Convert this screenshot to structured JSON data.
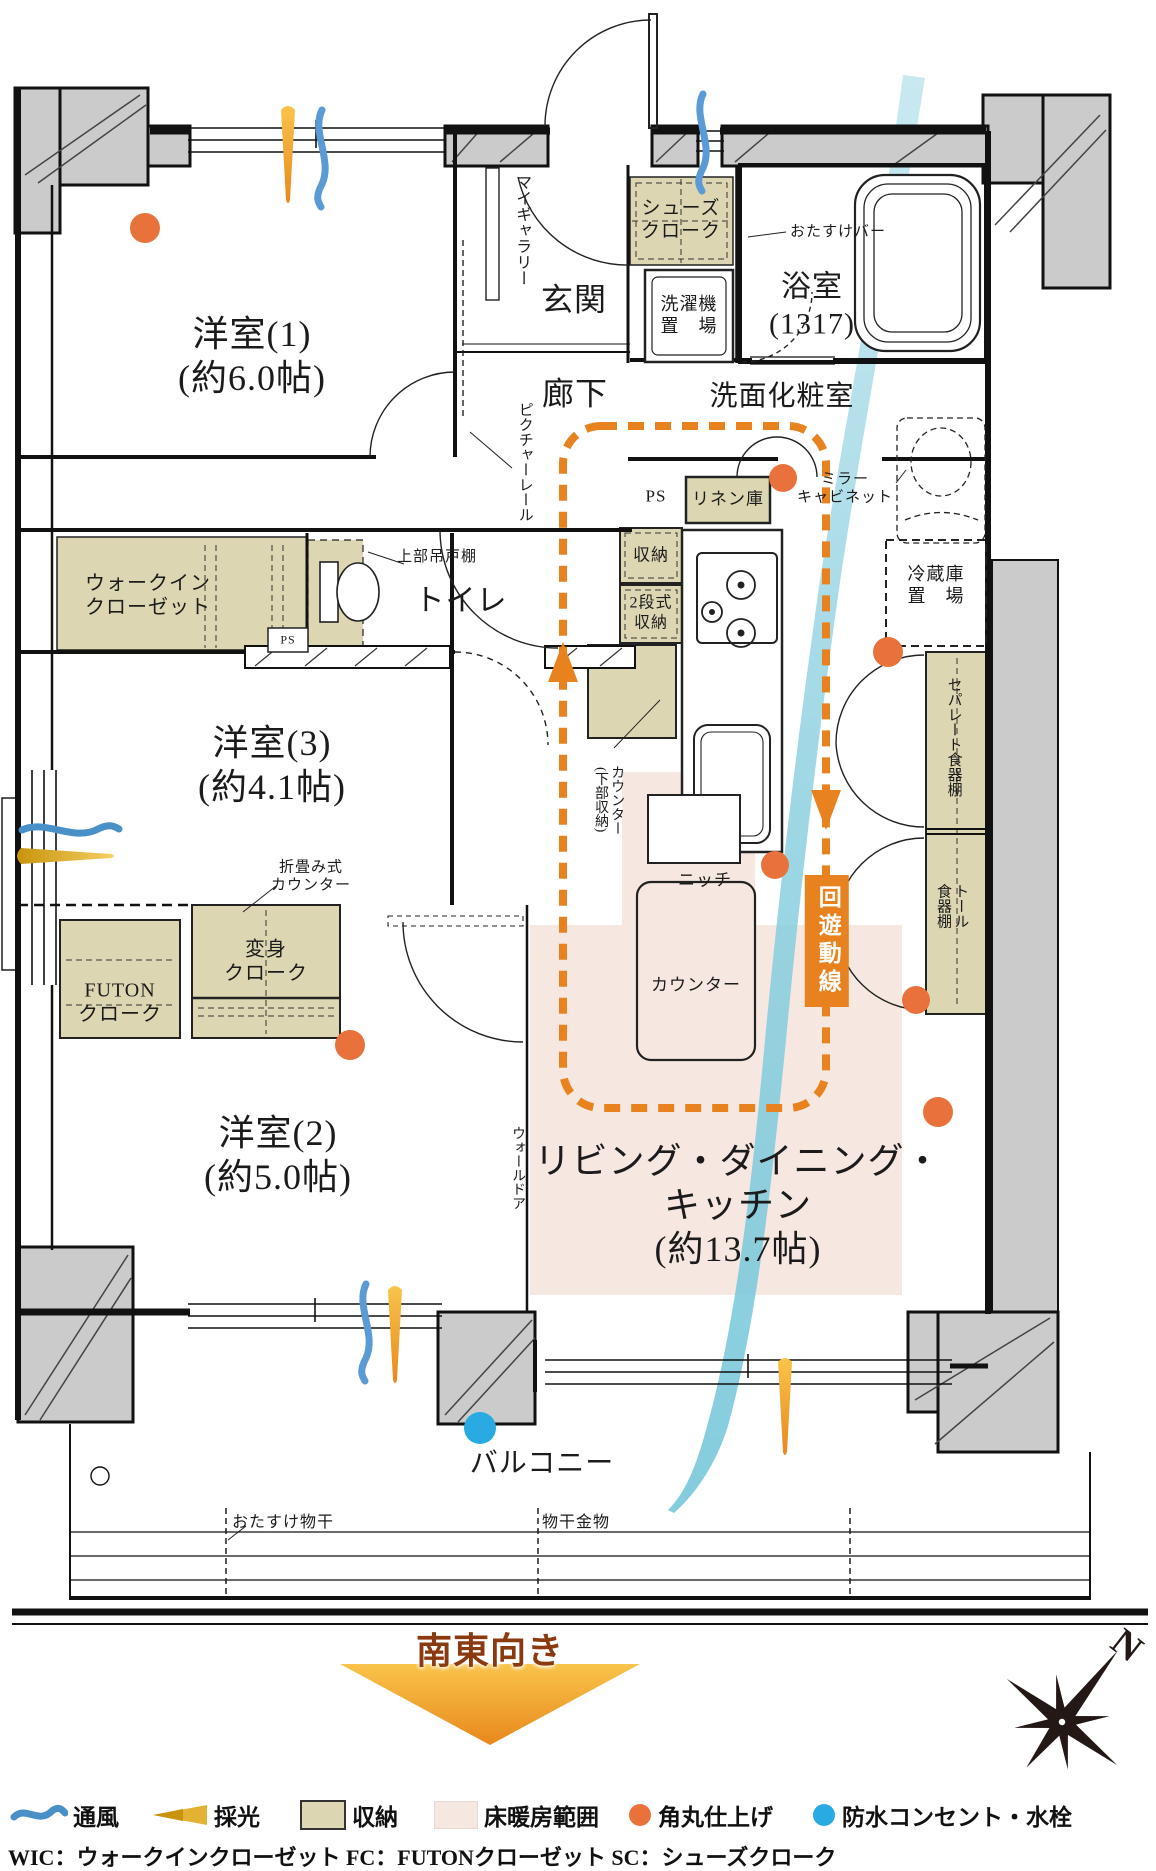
{
  "title": "マンション間取り図（3LDK）",
  "colors": {
    "accent_orange": "#e8821e",
    "corner_dot_orange": "#e8713c",
    "storage_tan": "#dcd7b2",
    "floor_heating_pink": "#f6e8e1",
    "waterproof_blue": "#29abe2",
    "breeze_blue": "#8fc9e0",
    "daylight_gold": "#f0b42e",
    "pillar_gray": "#cbcbcb",
    "direction_brown": "#8b3a10"
  },
  "plan": {
    "labels": [
      {
        "id": "room-yoshitsu1-label",
        "text": "洋室(1)\n(約6.0帖)",
        "x": 252,
        "y": 357,
        "fs": 36
      },
      {
        "id": "room-yoshitsu3-label",
        "text": "洋室(3)\n(約4.1帖)",
        "x": 272,
        "y": 766,
        "fs": 36
      },
      {
        "id": "room-yoshitsu2-label",
        "text": "洋室(2)\n(約5.0帖)",
        "x": 278,
        "y": 1156,
        "fs": 36
      },
      {
        "id": "room-ldk-label",
        "text": "リビング・ダイニング・\nキッチン\n(約13.7帖)",
        "x": 738,
        "y": 1206,
        "fs": 36
      },
      {
        "id": "room-genkan-label",
        "text": "玄関",
        "x": 574,
        "y": 300,
        "fs": 32
      },
      {
        "id": "room-rouka-label",
        "text": "廊下",
        "x": 575,
        "y": 394,
        "fs": 32
      },
      {
        "id": "room-yokushitsu-label",
        "text": "浴室\n(1317)",
        "x": 812,
        "y": 306,
        "fs": 30
      },
      {
        "id": "room-senmen-label",
        "text": "洗面化粧室",
        "x": 782,
        "y": 397,
        "fs": 28
      },
      {
        "id": "room-toilet-label",
        "text": "トイレ",
        "x": 461,
        "y": 602,
        "fs": 30
      },
      {
        "id": "room-balcony-label",
        "text": "バルコニー",
        "x": 542,
        "y": 1464,
        "fs": 28
      },
      {
        "id": "my-gallery-label",
        "text": "マイギャラリー",
        "x": 521,
        "y": 230,
        "fs": 16,
        "v": 1
      },
      {
        "id": "shoes-cloak-label",
        "text": "シューズ\nクローク",
        "x": 681,
        "y": 220,
        "fs": 19
      },
      {
        "id": "laundry-label",
        "text": "洗濯機\n置　場",
        "x": 689,
        "y": 316,
        "fs": 18
      },
      {
        "id": "otasuke-bar-label",
        "text": "おたすけバー",
        "x": 838,
        "y": 232,
        "fs": 15
      },
      {
        "id": "picture-rail-label",
        "text": "ピクチャーレール",
        "x": 524,
        "y": 462,
        "fs": 15,
        "v": 1
      },
      {
        "id": "mirror-cabinet-label",
        "text": "ミラー\nキャビネット",
        "x": 845,
        "y": 489,
        "fs": 15
      },
      {
        "id": "linen-label",
        "text": "リネン庫",
        "x": 728,
        "y": 500,
        "fs": 17
      },
      {
        "id": "ps-kitchen-label",
        "text": "PS",
        "x": 656,
        "y": 497,
        "fs": 17
      },
      {
        "id": "shuno-label",
        "text": "収納",
        "x": 651,
        "y": 556,
        "fs": 17
      },
      {
        "id": "two-step-shuno-label",
        "text": "2段式\n収納",
        "x": 651,
        "y": 613,
        "fs": 16
      },
      {
        "id": "upper-cabinet-label",
        "text": "上部吊戸棚",
        "x": 437,
        "y": 557,
        "fs": 15
      },
      {
        "id": "wic-label",
        "text": "ウォークイン\nクローゼット",
        "x": 148,
        "y": 596,
        "fs": 20
      },
      {
        "id": "ps-wic-label",
        "text": "PS",
        "x": 288,
        "y": 640,
        "fs": 12
      },
      {
        "id": "fridge-label",
        "text": "冷蔵庫\n置　場",
        "x": 936,
        "y": 586,
        "fs": 18
      },
      {
        "id": "separate-cupboard-label",
        "text": "セパレート食器棚",
        "x": 953,
        "y": 737,
        "fs": 15,
        "v": 1
      },
      {
        "id": "tall-cupboard-label",
        "text": "トール\n食器棚",
        "x": 951,
        "y": 906,
        "fs": 15,
        "v": 1
      },
      {
        "id": "counter-lower-storage-label",
        "text": "カウンター\n(下部収納)",
        "x": 608,
        "y": 800,
        "fs": 14,
        "v": 1
      },
      {
        "id": "folding-counter-label",
        "text": "折畳み式\nカウンター",
        "x": 311,
        "y": 877,
        "fs": 15
      },
      {
        "id": "henshin-cloak-label",
        "text": "変身\nクローク",
        "x": 266,
        "y": 962,
        "fs": 20
      },
      {
        "id": "futon-cloak-label",
        "text": "FUTON\nクローク",
        "x": 120,
        "y": 1003,
        "fs": 20
      },
      {
        "id": "niche-label",
        "text": "ニッチ",
        "x": 705,
        "y": 881,
        "fs": 17
      },
      {
        "id": "counter-island-label",
        "text": "カウンター",
        "x": 696,
        "y": 986,
        "fs": 17
      },
      {
        "id": "flow-line-label",
        "text": "回遊動線",
        "x": 827,
        "y": 941,
        "fs": 23,
        "v": 1,
        "cls": "flowbox"
      },
      {
        "id": "wall-door-label",
        "text": "ウォールドア",
        "x": 517,
        "y": 1168,
        "fs": 14,
        "v": 1
      },
      {
        "id": "otasuke-monohoshi-label",
        "text": "おたすけ物干",
        "x": 283,
        "y": 1523,
        "fs": 16
      },
      {
        "id": "monohoshi-kanamono-label",
        "text": "物干金物",
        "x": 576,
        "y": 1523,
        "fs": 16
      },
      {
        "id": "direction-label",
        "text": "南東向き",
        "x": 490,
        "y": 1652,
        "fs": 36,
        "cls": "dir",
        "color": "#8b3a10"
      },
      {
        "id": "compass-n-label",
        "text": "N",
        "x": 1127,
        "y": 1646,
        "fs": 38,
        "rot": 38,
        "cls": "dir",
        "color": "#231815"
      }
    ]
  },
  "legend": {
    "items": [
      {
        "label": "通風",
        "icon": "breeze-wave-icon"
      },
      {
        "label": "採光",
        "icon": "daylight-arrow-icon"
      },
      {
        "label": "収納",
        "icon": "storage-swatch-icon"
      },
      {
        "label": "床暖房範囲",
        "icon": "floor-heating-swatch-icon"
      },
      {
        "label": "角丸仕上げ",
        "icon": "rounded-corner-dot-icon"
      },
      {
        "label": "防水コンセント・水栓",
        "icon": "waterproof-outlet-dot-icon"
      }
    ],
    "abbreviations": "WIC：ウォークインクローゼット FC：FUTONクローゼット SC：シューズクローク"
  }
}
